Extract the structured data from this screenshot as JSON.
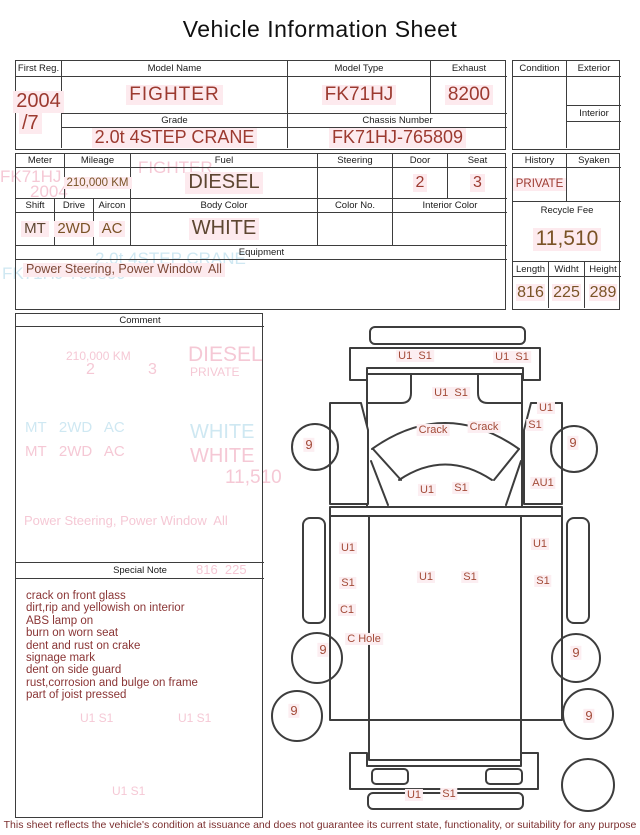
{
  "title": "Vehicle Information Sheet",
  "colors": {
    "line": "#3d3d3d",
    "value_red": "#9c3a30",
    "value_brown": "#7a5326",
    "value_dark": "#5d4631",
    "highlight": "#fdeaee",
    "ghost_pink": "#f5c6d3",
    "ghost_cyan": "#cde7f2",
    "note_red": "#8a3535",
    "diagram_label": "#a34b38"
  },
  "table1": {
    "first_reg_label": "First Reg.",
    "first_reg_year": "2004",
    "first_reg_month": "/7",
    "model_name_label": "Model Name",
    "model_name_value": "FIGHTER",
    "model_type_label": "Model Type",
    "model_type_value": "FK71HJ",
    "exhaust_label": "Exhaust",
    "exhaust_value": "8200",
    "grade_label": "Grade",
    "grade_value": "2.0t 4STEP CRANE",
    "chassis_label": "Chassis Number",
    "chassis_value": "FK71HJ-765809"
  },
  "condition_box": {
    "condition_label": "Condition",
    "condition_value": "",
    "exterior_label": "Exterior",
    "exterior_value": "",
    "interior_label": "Interior",
    "interior_value": ""
  },
  "table2": {
    "meter_label": "Meter",
    "meter_value": "",
    "mileage_label": "Mileage",
    "mileage_value": "210,000 KM",
    "fuel_label": "Fuel",
    "fuel_value": "DIESEL",
    "steering_label": "Steering",
    "steering_value": "",
    "door_label": "Door",
    "door_value": "2",
    "seat_label": "Seat",
    "seat_value": "3",
    "shift_label": "Shift",
    "shift_value": "MT",
    "drive_label": "Drive",
    "drive_value": "2WD",
    "aircon_label": "Aircon",
    "aircon_value": "AC",
    "body_color_label": "Body Color",
    "body_color_value": "WHITE",
    "color_no_label": "Color No.",
    "color_no_value": "",
    "interior_color_label": "Interior Color",
    "interior_color_value": "",
    "equipment_label": "Equipment",
    "equipment_value": "Power Steering, Power Window  All"
  },
  "history_box": {
    "history_label": "History",
    "history_value": "PRIVATE",
    "syaken_label": "Syaken",
    "syaken_value": "",
    "recycle_fee_label": "Recycle Fee",
    "recycle_fee_value": "11,510",
    "length_label": "Length",
    "length_value": "816",
    "width_label": "Widht",
    "width_value": "225",
    "height_label": "Height",
    "height_value": "289"
  },
  "comment": {
    "label": "Comment",
    "value": ""
  },
  "special_note": {
    "label": "Special Note",
    "lines": [
      "crack on front glass",
      "dirt,rip and yellowish on interior",
      "ABS lamp on",
      "burn on worn seat",
      "dent and rust on crake",
      "signage mark",
      "dent on side guard",
      "rust,corrosion and bulge on frame",
      "part of joist pressed"
    ]
  },
  "diagram": {
    "labels": [
      {
        "t": "U1  S1",
        "x": 415,
        "y": 356
      },
      {
        "t": "U1  S1",
        "x": 512,
        "y": 357
      },
      {
        "t": "U1  S1",
        "x": 451,
        "y": 393
      },
      {
        "t": "Crack",
        "x": 433,
        "y": 430
      },
      {
        "t": "Crack",
        "x": 484,
        "y": 427
      },
      {
        "t": "U1",
        "x": 546,
        "y": 408
      },
      {
        "t": "S1",
        "x": 535,
        "y": 425
      },
      {
        "t": "U1",
        "x": 427,
        "y": 490
      },
      {
        "t": "S1",
        "x": 461,
        "y": 488
      },
      {
        "t": "AU1",
        "x": 543,
        "y": 483
      },
      {
        "t": "U1",
        "x": 348,
        "y": 548
      },
      {
        "t": "S1",
        "x": 348,
        "y": 583
      },
      {
        "t": "C1",
        "x": 347,
        "y": 610
      },
      {
        "t": "C Hole",
        "x": 364,
        "y": 639
      },
      {
        "t": "U1",
        "x": 426,
        "y": 577
      },
      {
        "t": "S1",
        "x": 470,
        "y": 577
      },
      {
        "t": "U1",
        "x": 540,
        "y": 544
      },
      {
        "t": "S1",
        "x": 543,
        "y": 581
      },
      {
        "t": "U1",
        "x": 414,
        "y": 795
      },
      {
        "t": "S1",
        "x": 449,
        "y": 794
      },
      {
        "t": "9",
        "x": 309,
        "y": 445,
        "size": 13
      },
      {
        "t": "9",
        "x": 573,
        "y": 443,
        "size": 13
      },
      {
        "t": "9",
        "x": 323,
        "y": 650,
        "size": 13
      },
      {
        "t": "9",
        "x": 576,
        "y": 653,
        "size": 13
      },
      {
        "t": "9",
        "x": 294,
        "y": 711,
        "size": 13
      },
      {
        "t": "9",
        "x": 589,
        "y": 716,
        "size": 13
      }
    ]
  },
  "ghosts": [
    {
      "t": "FK71HJ",
      "x": 0,
      "y": 168,
      "size": 17,
      "color": "#f5c6d3"
    },
    {
      "t": "2004",
      "x": 30,
      "y": 183,
      "size": 17,
      "color": "#f5c6d3"
    },
    {
      "t": "FIGHTER",
      "x": 138,
      "y": 159,
      "size": 17,
      "color": "#f5c6d3"
    },
    {
      "t": "8200",
      "x": 92,
      "y": 175,
      "size": 17,
      "color": "#f5c6d3"
    },
    {
      "t": "2.0t 4STEP CRANE",
      "x": 95,
      "y": 250,
      "size": 17,
      "color": "#cde7f2"
    },
    {
      "t": "FK71HJ-765809",
      "x": 2,
      "y": 265,
      "size": 17,
      "color": "#cde7f2"
    },
    {
      "t": "210,000 KM",
      "x": 66,
      "y": 350,
      "size": 12,
      "color": "#f5c6d3"
    },
    {
      "t": "2",
      "x": 86,
      "y": 362,
      "size": 16,
      "color": "#f5c6d3"
    },
    {
      "t": "3",
      "x": 148,
      "y": 362,
      "size": 16,
      "color": "#f5c6d3"
    },
    {
      "t": "DIESEL",
      "x": 188,
      "y": 344,
      "size": 21,
      "color": "#f5c6d3"
    },
    {
      "t": "PRIVATE",
      "x": 190,
      "y": 366,
      "size": 12,
      "color": "#f5c6d3"
    },
    {
      "t": "MT   2WD   AC",
      "x": 25,
      "y": 420,
      "size": 15,
      "color": "#cde7f2"
    },
    {
      "t": "WHITE",
      "x": 190,
      "y": 422,
      "size": 20,
      "color": "#cde7f2"
    },
    {
      "t": "MT   2WD   AC",
      "x": 25,
      "y": 444,
      "size": 15,
      "color": "#f5c6d3"
    },
    {
      "t": "WHITE",
      "x": 190,
      "y": 446,
      "size": 20,
      "color": "#f5c6d3"
    },
    {
      "t": "11,510",
      "x": 225,
      "y": 468,
      "size": 19,
      "color": "#f5c6d3"
    },
    {
      "t": "Power Steering, Power Window  All",
      "x": 24,
      "y": 514,
      "size": 13,
      "color": "#f5c6d3"
    },
    {
      "t": "816  225",
      "x": 196,
      "y": 563,
      "size": 13,
      "color": "#f5c6d3"
    },
    {
      "t": "U1 S1",
      "x": 80,
      "y": 712,
      "size": 12,
      "color": "#f5c6d3"
    },
    {
      "t": "U1 S1",
      "x": 178,
      "y": 712,
      "size": 12,
      "color": "#f5c6d3"
    },
    {
      "t": "U1 S1",
      "x": 112,
      "y": 785,
      "size": 12,
      "color": "#f5c6d3"
    }
  ],
  "footer": "This sheet reflects the vehicle's condition at issuance and does not guarantee its current state, functionality, or suitability for any purpose"
}
